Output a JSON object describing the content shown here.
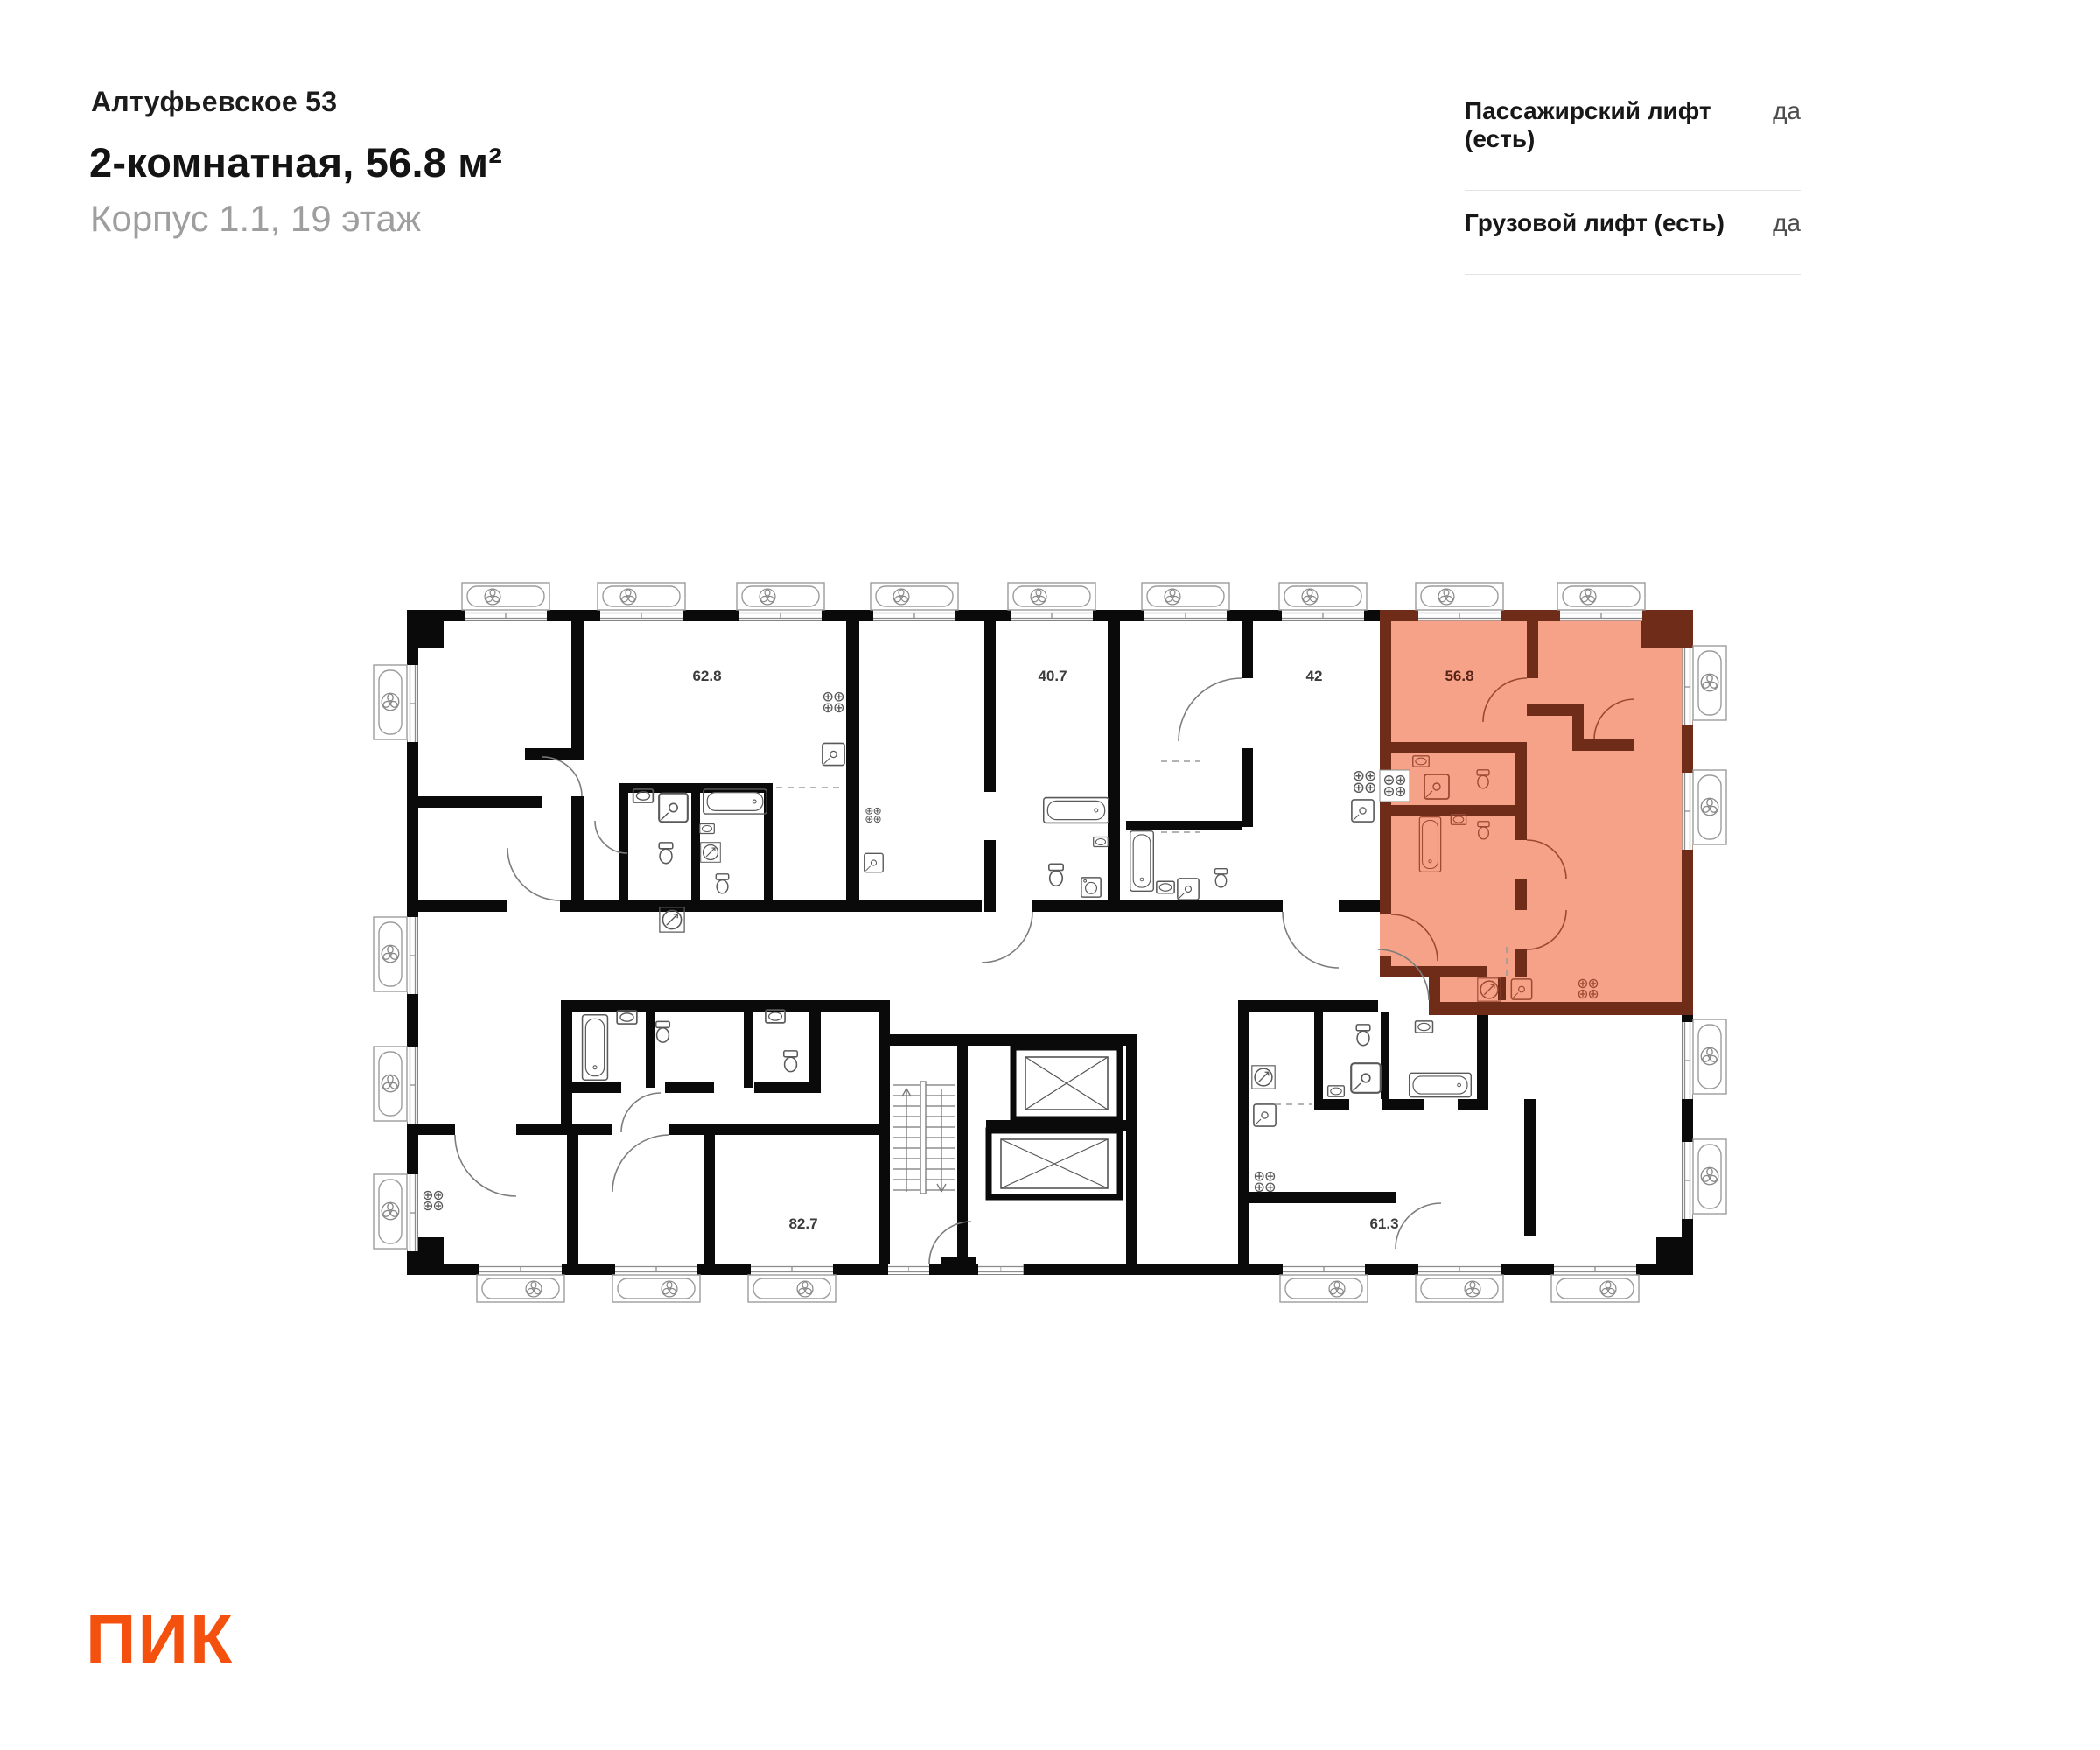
{
  "header": {
    "project_name": "Алтуфьевское 53",
    "title": "2-комнатная, 56.8 м²",
    "subtitle": "Корпус 1.1, 19 этаж"
  },
  "lift_info": {
    "rows": [
      {
        "label": "Пассажирский лифт (есть)",
        "value": "да"
      },
      {
        "label": "Грузовой лифт (есть)",
        "value": "да"
      }
    ]
  },
  "floor_plan": {
    "highlighted_unit": {
      "area_label": "56.8",
      "fill_color": "#F5A288",
      "wall_color": "#6E2C19"
    },
    "other_units": [
      "62.8",
      "40.7",
      "42",
      "82.7",
      "61.3"
    ],
    "wall_color": "#0A0A0A",
    "line_color": "#8C8C8C"
  },
  "logo": {
    "text": "ПИК",
    "color": "#F4510E"
  }
}
